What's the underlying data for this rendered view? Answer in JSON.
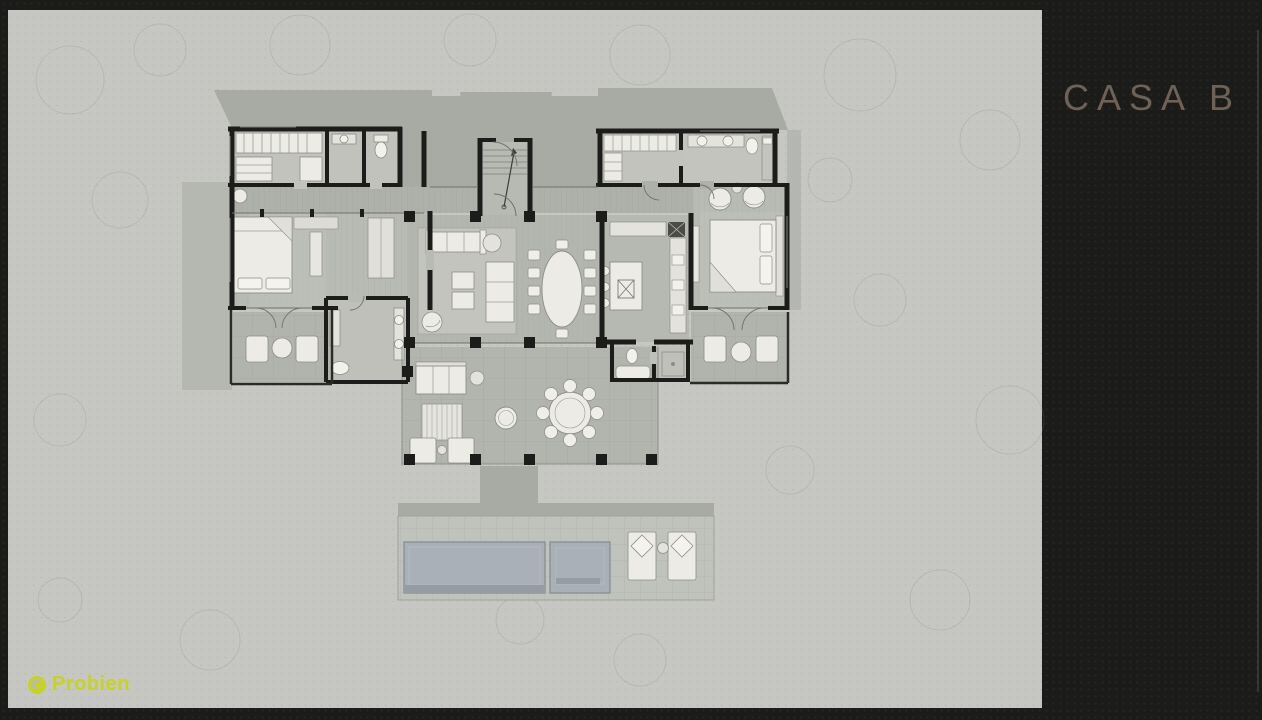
{
  "slide": {
    "title": "CASA B",
    "brand": "Probien"
  },
  "palette": {
    "frame_bg": "#1b1b1a",
    "plan_bg": "#c6c7c3",
    "shadow": "#a8aaa4",
    "wall": "#1c1c1a",
    "furniture": "#ecebe5",
    "counter": "#e3e2dc",
    "pool_water": "#a9b0b8",
    "pool_dark": "#959ca4",
    "deck": "#aeb0aa",
    "floor": "#b3b5af",
    "title_color": "#6f6155",
    "logo_color": "#c6d320"
  }
}
